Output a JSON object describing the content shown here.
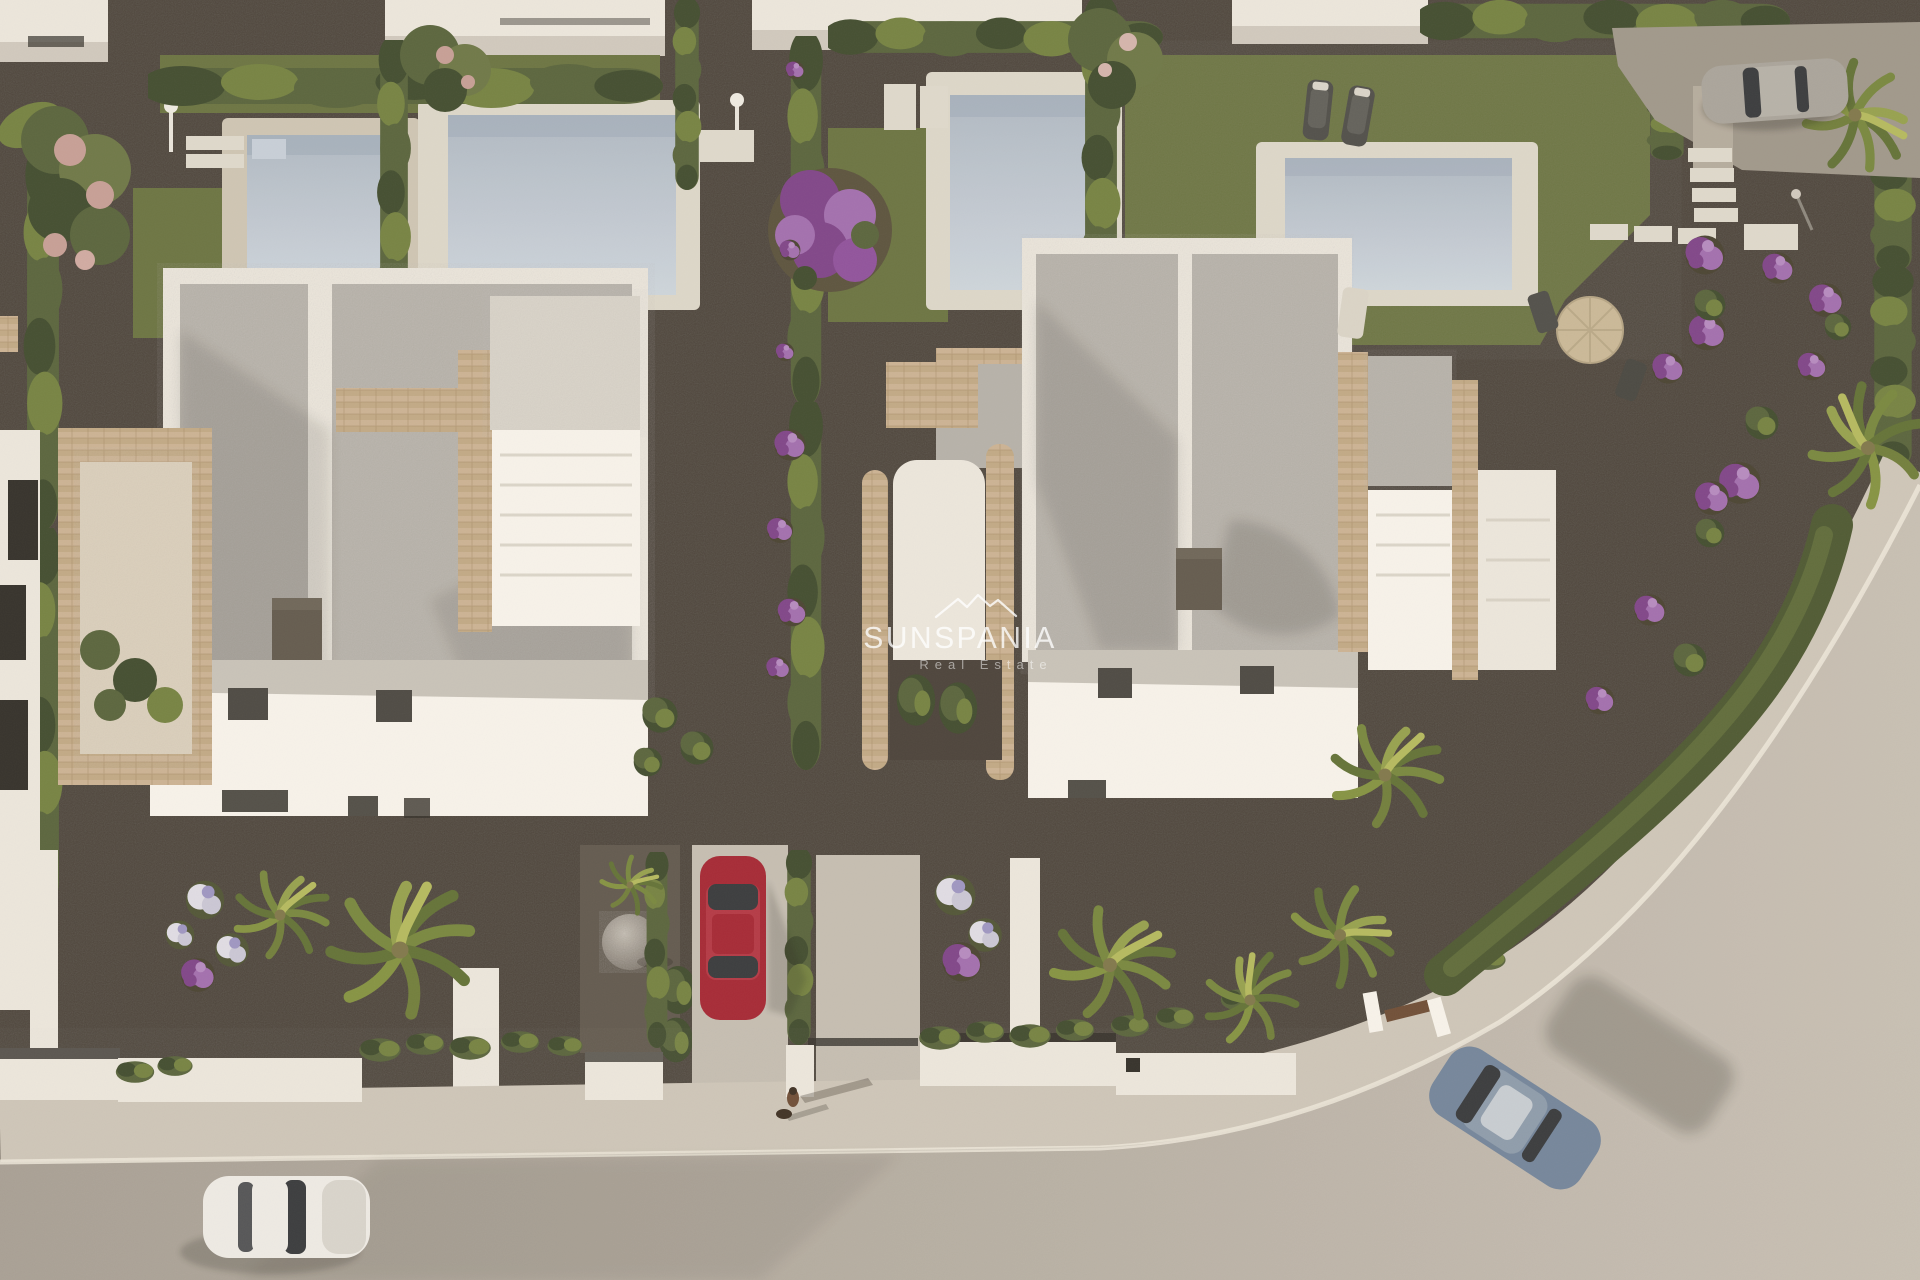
{
  "watermark": {
    "brand": "SUNSPANIA",
    "tagline": "Real Estate",
    "logo": "mountain-peaks-icon"
  },
  "scene": {
    "type": "3d-aerial-architectural-render",
    "setting": "Bird's-eye render of a residential development: two modern white duplex villas with flat grey roofs, travertine stairs, private pools and landscaped gardens beside a curved street",
    "objects": [
      "left white villa duplex with grey flat roof and chimney",
      "right white villa duplex with grey flat roof and chimney",
      "four swimming pools with decks",
      "travertine stone staircases and terraces",
      "cypress hedges and hedge rows",
      "palm trees",
      "purple flowering shrubs and bougainvillea",
      "pink flowering trees",
      "lawn areas",
      "red car parked in driveway",
      "white car on road",
      "blue car driving on road",
      "silver car in rear drive",
      "two sun loungers",
      "round parasol with garden chairs",
      "white stepping-stone paths",
      "decorative gravel sphere",
      "outdoor showers",
      "pedestrian walking a dog",
      "curved asphalt road with sidewalk and kerb",
      "white boundary walls with dark copings",
      "wooden entrance gate"
    ]
  },
  "colors": {
    "villa_white": "#ebe7de",
    "roof_gray": "#b4b0a9",
    "stone_beige": "#c2ab87",
    "chimney_gray": "#5e574b",
    "pool_water": "#b9c3ce",
    "pool_deck": "#cdc5b4",
    "grass_green": "#67713f",
    "hedge_green": "#55623a",
    "gravel_dark": "#463f37",
    "gravel_light": "#9d968a",
    "road_gray": "#b3aba1",
    "sidewalk_gray": "#cdc6b9",
    "flower_purple": "#7c4187",
    "blossom_pink": "#c59e95",
    "car_red": "#a32331",
    "car_blue": "#70839a",
    "car_white": "#edebe6",
    "car_silver": "#a7a39a",
    "watermark_white": "#ffffff"
  }
}
